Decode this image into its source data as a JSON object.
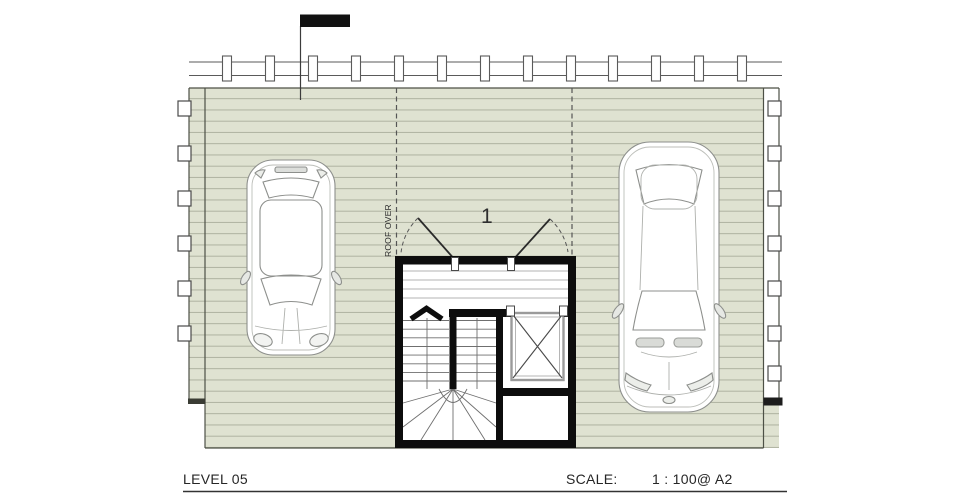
{
  "title_block": {
    "level": "LEVEL 05",
    "scale_label": "SCALE:",
    "scale_value": "1 : 100@ A2"
  },
  "plan": {
    "roof_over_label": "ROOF OVER",
    "stair_number": "1",
    "components": {
      "deck": "roof-deck-with-boards",
      "band": "pergola-beam-with-battens",
      "marker": "black-flag-marker",
      "core": "stair-and-elevator-core",
      "car_left": "hatchback-top-view",
      "car_right": "sedan-top-view"
    }
  },
  "colors": {
    "deck_fill": "#dfe2d1",
    "deck_board_line": "#a9ad9b",
    "deck_edge": "#4d5046",
    "gray_line": "#5a5a5a",
    "wall_black": "#0d0d0d",
    "dashed_line": "#555555",
    "elevator_gray": "#9a9a9a",
    "car_stroke": "#8d8f8c",
    "text": "#262626"
  }
}
